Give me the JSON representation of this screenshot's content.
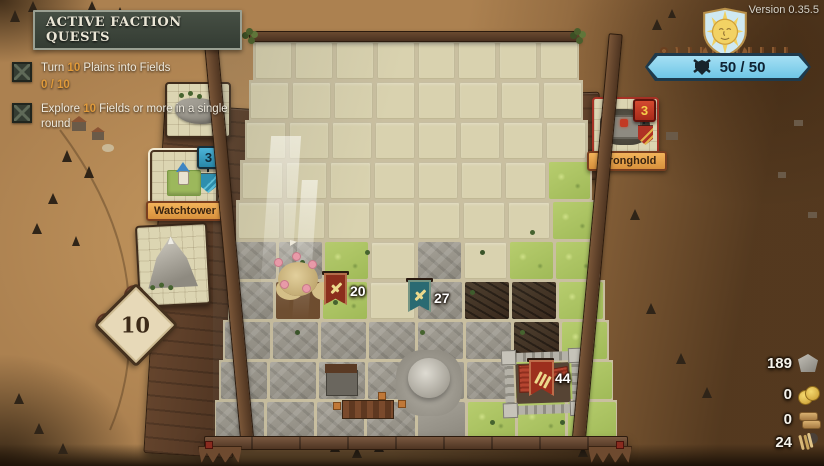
{
  "version_label": "Version 0.35.5",
  "quest_panel": {
    "title": "ACTIVE FACTION QUESTS",
    "quests": [
      {
        "prefix": "Turn ",
        "highlight": "10",
        "suffix": " Plains into Fields",
        "progress": "0 / 10"
      },
      {
        "prefix": "Explore ",
        "highlight": "10",
        "suffix": " Fields or more in a single round",
        "progress": ""
      }
    ]
  },
  "hand": {
    "selected_card": {
      "label": "Watchtower",
      "count": "3"
    },
    "cards": [
      {
        "name": "rock-ridge-card"
      },
      {
        "name": "watchtower-card"
      },
      {
        "name": "mountain-card"
      }
    ]
  },
  "tiles_remaining": "10",
  "enemy_card": {
    "label": "Stronghold",
    "count": "3"
  },
  "hp_banner": {
    "value": "50 / 50"
  },
  "resources": [
    {
      "name": "stone",
      "value": "189"
    },
    {
      "name": "gold",
      "value": "0"
    },
    {
      "name": "wood",
      "value": "0"
    },
    {
      "name": "wheat",
      "value": "24"
    }
  ],
  "board": {
    "columns": 8,
    "rows": 10,
    "legend": {
      ".": "empty",
      "g": "grass",
      "r": "rock",
      "d": "scorched",
      "f": "flowers",
      "m": "dome",
      "c": "castle-grass"
    },
    "tiles": [
      "........",
      "........",
      "........",
      ".......g",
      ".......g",
      "rrg.r.gg",
      "rfg.rddg",
      "rrrrrrdg",
      "rrrrmrgc",
      "rrrrmggc"
    ],
    "units": [
      {
        "id": "red-army",
        "value": "20",
        "color": "#8b2e1c"
      },
      {
        "id": "teal-army",
        "value": "27",
        "color": "#2a6a72"
      },
      {
        "id": "castle-garrison",
        "value": "44",
        "color": "#9c2f1d"
      }
    ]
  },
  "colors": {
    "table": "#b58a54",
    "empty_tile": "#d9d2af",
    "grass": "#aec566",
    "rock": "#9c9890",
    "scorched": "#46382a",
    "hp_blue": "#7ccbe9",
    "badge_blue": "#2e9bc0",
    "badge_red": "#c23a24",
    "label_orange": "#e8a84f",
    "quest_highlight": "#e09a3a"
  }
}
